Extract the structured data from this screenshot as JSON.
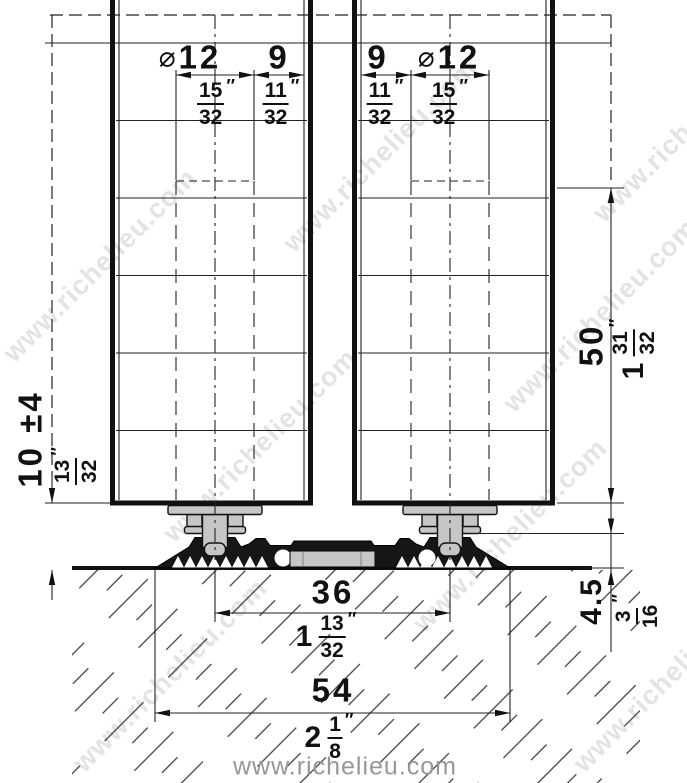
{
  "marks": {
    "diameter": "⌀",
    "inch": "″"
  },
  "dims": {
    "hole_dia_left": {
      "mm": "12",
      "num": "15",
      "den": "32"
    },
    "edge_gap_left": {
      "mm": "9",
      "num": "11",
      "den": "32"
    },
    "edge_gap_right": {
      "mm": "9",
      "num": "11",
      "den": "32"
    },
    "hole_dia_right": {
      "mm": "12",
      "num": "15",
      "den": "32"
    },
    "hole_depth": {
      "mm": "50",
      "whole": "1",
      "num": "31",
      "den": "32"
    },
    "floor_gap": {
      "mm": "10 ±4",
      "num": "13",
      "den": "32"
    },
    "track_height": {
      "mm": "4.5",
      "num": "3",
      "den": "16"
    },
    "pin_spacing": {
      "mm": "36",
      "whole": "1",
      "num": "13",
      "den": "32"
    },
    "track_width": {
      "mm": "54",
      "whole": "2",
      "num": "1",
      "den": "8"
    }
  },
  "watermark": {
    "text": "www.richelieu.com"
  },
  "footer": {
    "url": "www.richelieu.com"
  }
}
